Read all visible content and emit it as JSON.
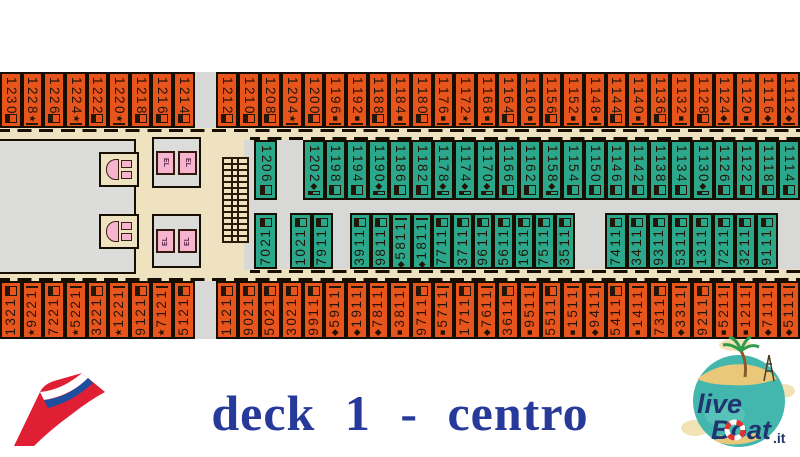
{
  "title": "deck 1 - centro",
  "elevator_label": "EL",
  "symbols": {
    "star": "★",
    "sq": "■",
    "di": "◆"
  },
  "colors": {
    "cabin_orange": "#e8551c",
    "cabin_green": "#2ba88b",
    "corridor_beige": "#efe2c0",
    "void_gray": "#d8d8d6",
    "wall_ink": "#170e02",
    "facility_pink": "#f6b4cf",
    "title_blue": "#283a99",
    "carnival_red": "#e01f35",
    "globe_teal": "#43b7ad"
  },
  "branding": {
    "carnival_logo": "carnival-funnel",
    "liveboat": {
      "live": "live",
      "boat": "Boat",
      "it": ".it"
    }
  },
  "deck": {
    "rows": [
      {
        "id": "deck-row-outer-top",
        "cells": [
          {
            "n": "1230"
          },
          {
            "n": "1228",
            "s": "star"
          },
          {
            "n": "1226"
          },
          {
            "n": "1224",
            "s": "star"
          },
          {
            "n": "1222"
          },
          {
            "n": "1220",
            "s": "star"
          },
          {
            "n": "1218"
          },
          {
            "n": "1216"
          },
          {
            "n": "1214"
          },
          {
            "gap": true
          },
          {
            "n": "1212"
          },
          {
            "n": "1210"
          },
          {
            "n": "1208"
          },
          {
            "n": "1204",
            "s": "star"
          },
          {
            "n": "1200"
          },
          {
            "n": "1196",
            "s": "sq"
          },
          {
            "n": "1192",
            "s": "sq"
          },
          {
            "n": "1188"
          },
          {
            "n": "1184",
            "s": "sq"
          },
          {
            "n": "1180"
          },
          {
            "n": "1176",
            "s": "sq"
          },
          {
            "n": "1172",
            "s": "star"
          },
          {
            "n": "1168",
            "s": "sq"
          },
          {
            "n": "1164"
          },
          {
            "n": "1160",
            "s": "sq"
          },
          {
            "n": "1156"
          },
          {
            "n": "1152",
            "s": "sq"
          },
          {
            "n": "1148",
            "s": "sq"
          },
          {
            "n": "1144"
          },
          {
            "n": "1140",
            "s": "sq"
          },
          {
            "n": "1136"
          },
          {
            "n": "1132",
            "s": "sq"
          },
          {
            "n": "1128"
          },
          {
            "n": "1124",
            "s": "di"
          },
          {
            "n": "1120",
            "s": "sq"
          },
          {
            "n": "1116",
            "s": "di"
          },
          {
            "n": "1112",
            "s": "di"
          }
        ]
      },
      {
        "id": "deck-row-inner-upper",
        "cells": [
          {
            "n": "1206",
            "w": 23
          },
          {
            "gap": true,
            "w": 26
          },
          {
            "n": "1202",
            "s": "di"
          },
          {
            "n": "1198"
          },
          {
            "n": "1194"
          },
          {
            "n": "1190",
            "s": "di"
          },
          {
            "n": "1186"
          },
          {
            "n": "1182"
          },
          {
            "n": "1178",
            "s": "di"
          },
          {
            "n": "1174",
            "s": "di"
          },
          {
            "n": "1170",
            "s": "di"
          },
          {
            "n": "1166"
          },
          {
            "n": "1162"
          },
          {
            "n": "1158",
            "s": "di"
          },
          {
            "n": "1154"
          },
          {
            "n": "1150"
          },
          {
            "n": "1146"
          },
          {
            "n": "1142"
          },
          {
            "n": "1138"
          },
          {
            "n": "1134"
          },
          {
            "n": "1130",
            "s": "di"
          },
          {
            "n": "1126"
          },
          {
            "n": "1122"
          },
          {
            "n": "1118"
          },
          {
            "n": "1114"
          }
        ]
      },
      {
        "id": "deck-row-inner-lower",
        "cells": [
          {
            "n": "1207",
            "w": 23
          },
          {
            "gap": true,
            "w": 13
          },
          {
            "n": "1201"
          },
          {
            "n": "1197"
          },
          {
            "gap": true,
            "w": 17
          },
          {
            "n": "1193",
            "w": 20.45
          },
          {
            "n": "1189",
            "w": 20.45
          },
          {
            "n": "1185",
            "s": "di",
            "w": 20.45
          },
          {
            "n": "1181",
            "s": "di",
            "w": 20.45
          },
          {
            "n": "1177",
            "w": 20.45
          },
          {
            "n": "1173",
            "w": 20.45
          },
          {
            "n": "1169",
            "w": 20.45
          },
          {
            "n": "1165",
            "w": 20.45
          },
          {
            "n": "1161",
            "w": 20.45
          },
          {
            "n": "1157",
            "w": 20.45
          },
          {
            "n": "1153",
            "w": 20.45
          },
          {
            "gap": true,
            "w": 30
          },
          {
            "n": "1147"
          },
          {
            "n": "1143"
          },
          {
            "n": "1139"
          },
          {
            "n": "1135"
          },
          {
            "n": "1131"
          },
          {
            "n": "1127"
          },
          {
            "n": "1123"
          },
          {
            "n": "1119"
          }
        ]
      },
      {
        "id": "deck-row-outer-bottom",
        "cells": [
          {
            "n": "1231"
          },
          {
            "n": "1229",
            "s": "star"
          },
          {
            "n": "1227"
          },
          {
            "n": "1225",
            "s": "star"
          },
          {
            "n": "1223"
          },
          {
            "n": "1221",
            "s": "star"
          },
          {
            "n": "1219"
          },
          {
            "n": "1217",
            "s": "star"
          },
          {
            "n": "1215"
          },
          {
            "gap": true
          },
          {
            "n": "1211"
          },
          {
            "n": "1209"
          },
          {
            "n": "1205"
          },
          {
            "n": "1203"
          },
          {
            "n": "1199"
          },
          {
            "n": "1195",
            "s": "di"
          },
          {
            "n": "1191",
            "s": "di"
          },
          {
            "n": "1187",
            "s": "di"
          },
          {
            "n": "1183",
            "s": "sq"
          },
          {
            "n": "1179"
          },
          {
            "n": "1175",
            "s": "sq"
          },
          {
            "n": "1171"
          },
          {
            "n": "1167",
            "s": "di"
          },
          {
            "n": "1163"
          },
          {
            "n": "1159",
            "s": "sq"
          },
          {
            "n": "1155"
          },
          {
            "n": "1151",
            "s": "sq"
          },
          {
            "n": "1149",
            "s": "di"
          },
          {
            "n": "1145"
          },
          {
            "n": "1141",
            "s": "sq"
          },
          {
            "n": "1137"
          },
          {
            "n": "1133",
            "s": "di"
          },
          {
            "n": "1129"
          },
          {
            "n": "1125",
            "s": "sq"
          },
          {
            "n": "1121",
            "s": "sq"
          },
          {
            "n": "1117",
            "s": "di"
          },
          {
            "n": "1115",
            "s": "di"
          }
        ]
      }
    ]
  }
}
